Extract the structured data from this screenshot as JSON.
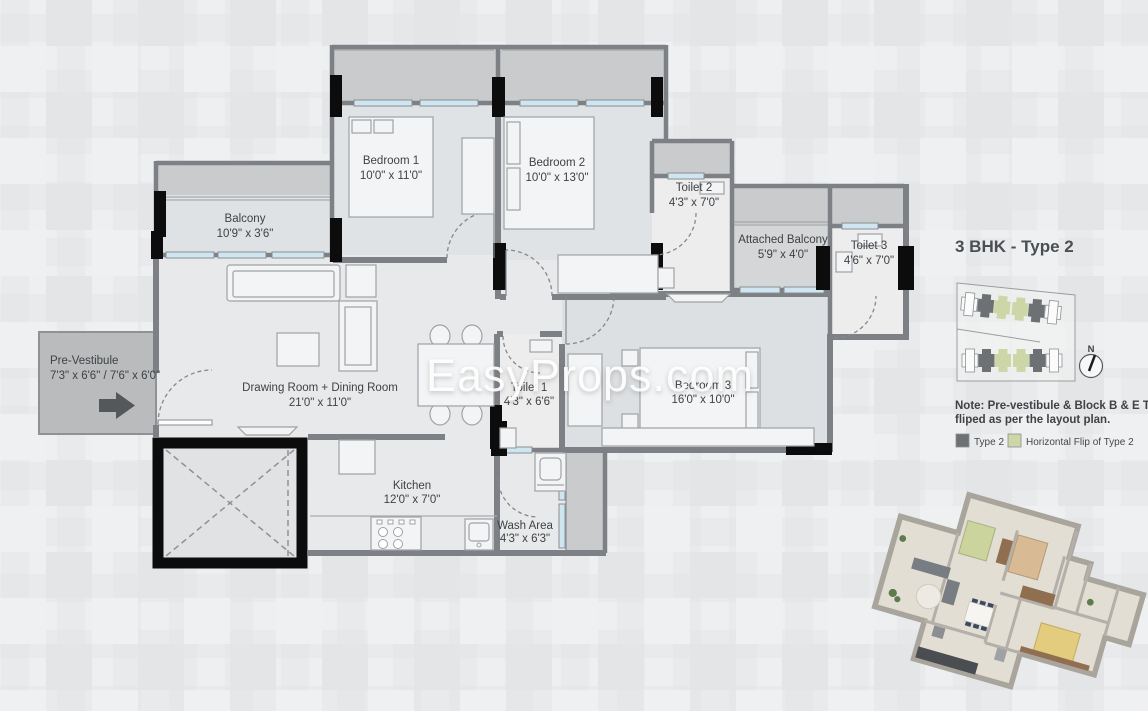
{
  "watermark": "EasyProps.com",
  "panel": {
    "title": "3 BHK - Type 2",
    "note_line1": "Note: Pre-vestibule & Block B & E Toilet 3",
    "note_line2": "fliped as per the layout plan.",
    "north_label": "N",
    "legend": [
      {
        "label": "Type 2",
        "color": "#6e7174"
      },
      {
        "label": "Horizontal Flip of Type 2",
        "color": "#cdd6a6"
      }
    ]
  },
  "rooms": {
    "balcony": {
      "name": "Balcony",
      "dims": "10'9\" x 3'6\""
    },
    "bedroom1": {
      "name": "Bedroom 1",
      "dims": "10'0\" x 11'0\""
    },
    "bedroom2": {
      "name": "Bedroom 2",
      "dims": "10'0\" x 13'0\""
    },
    "toilet2": {
      "name": "Toilet 2",
      "dims": "4'3\" x 7'0\""
    },
    "attached_balcony": {
      "name": "Attached Balcony",
      "dims": "5'9\" x 4'0\""
    },
    "toilet3": {
      "name": "Toilet 3",
      "dims": "4'6\" x 7'0\""
    },
    "pre_vestibule": {
      "name": "Pre-Vestibule",
      "dims": "7'3\" x 6'6\" / 7'6\" x 6'0\""
    },
    "drawing_dining": {
      "name": "Drawing Room + Dining Room",
      "dims": "21'0\" x 11'0\""
    },
    "toilet1": {
      "name": "Toilet 1",
      "dims": "4'3\" x 6'6\""
    },
    "bedroom3": {
      "name": "Bedroom 3",
      "dims": "16'0\" x 10'0\""
    },
    "kitchen": {
      "name": "Kitchen",
      "dims": "12'0\" x 7'0\""
    },
    "wash_area": {
      "name": "Wash Area",
      "dims": "4'3\" x 6'3\""
    }
  },
  "colors": {
    "wall": "#7d8084",
    "column": "#0c0c0c",
    "window": "#cfe6f2",
    "type2": "#6e7174",
    "flip_type2": "#cdd6a6",
    "background": "#e9eaec"
  }
}
